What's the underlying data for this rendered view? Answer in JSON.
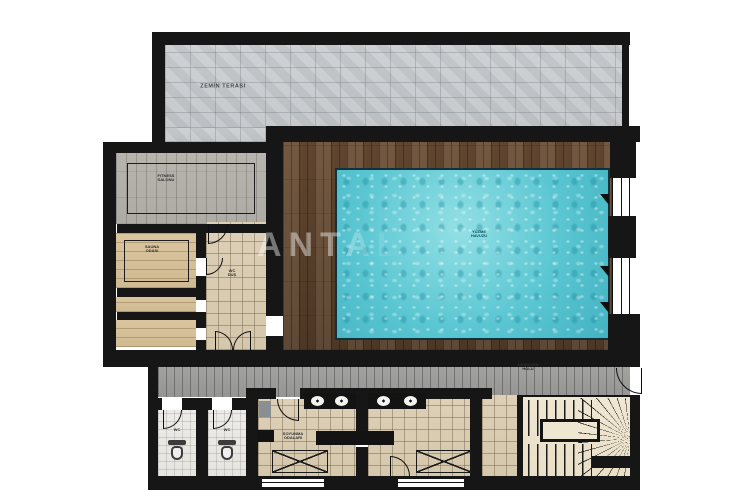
{
  "plan": {
    "watermark": "ANTAL",
    "rooms": {
      "terrace": {
        "label": "ZEMİN TERASI"
      },
      "fitness": {
        "label_line1": "FITNESS",
        "label_line2": "SALONU"
      },
      "sauna": {
        "label_line1": "SAUNA",
        "label_line2": "ODASI"
      },
      "hall": {
        "label_line1": "WC",
        "label_line2": "DUŞ"
      },
      "pool": {
        "label_line1": "YÜZME",
        "label_line2": "HAVUZU"
      },
      "changing": {
        "label_line1": "SOYUNMA",
        "label_line2": "ODALARI"
      },
      "wc_left": {
        "label": "WC"
      },
      "wc_right": {
        "label": "WC"
      },
      "stair_hall": {
        "label_line1": "MERDİVEN",
        "label_line2": "HOLÜ"
      }
    },
    "icons": {
      "toilet": "toilet-icon",
      "sink": "sink-icon",
      "door": "door-swing-icon",
      "window_marker": "window-triangle-icon",
      "stairs": "staircase"
    },
    "colors": {
      "wall": "#161616",
      "stone": "#c8ccce",
      "deck_wood": "#5f4731",
      "water": "#5ac6d2",
      "pool_border": "#10323c",
      "beige_tile": "#dbceb5",
      "sauna_wood": "#d6c19b",
      "gray_wood": "#b4b1ab",
      "gray_plank": "#9d9d9b",
      "wc_floor": "#eae8e3",
      "stair_floor": "#efe6d2"
    }
  }
}
